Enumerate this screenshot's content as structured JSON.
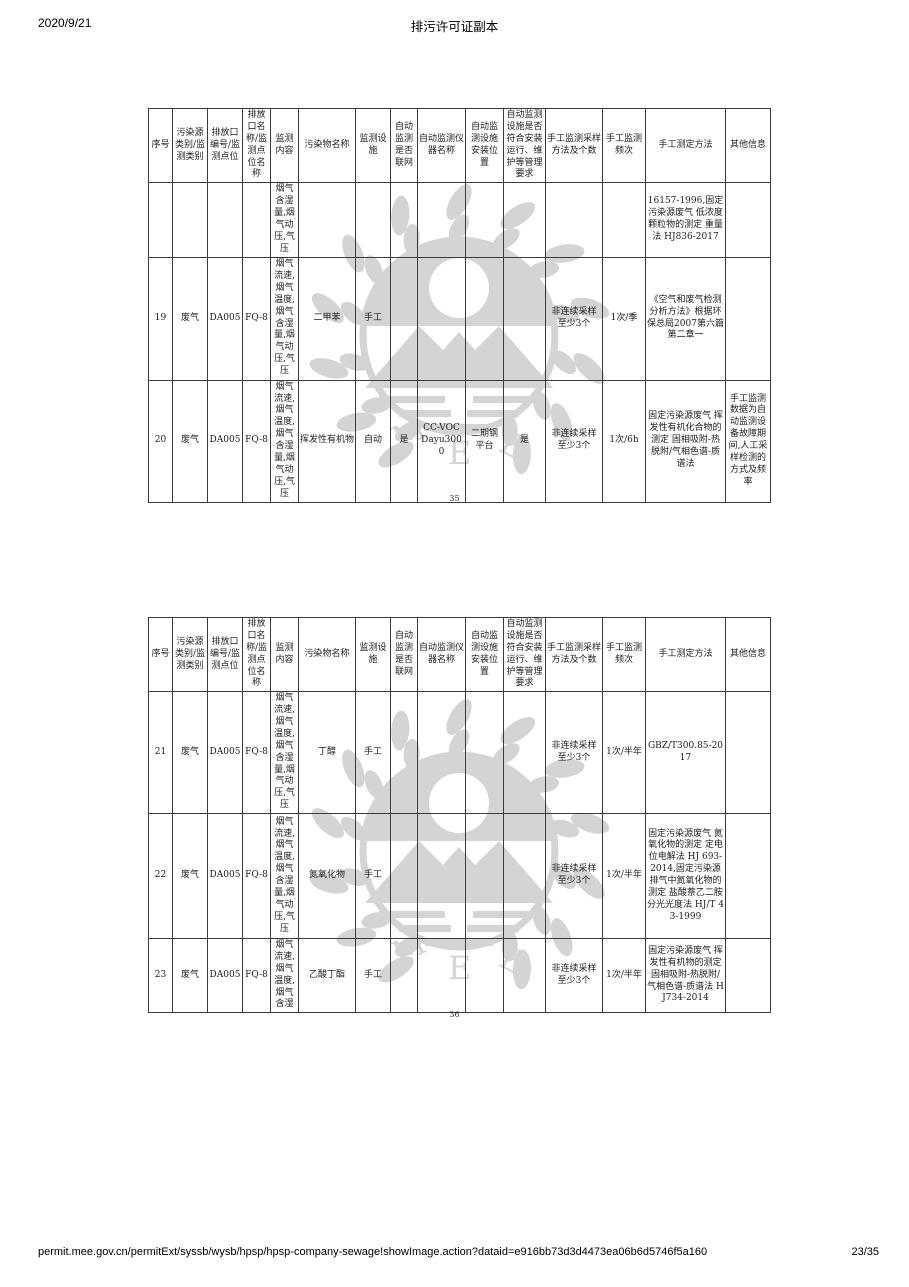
{
  "header": {
    "date": "2020/9/21",
    "title": "排污许可证副本"
  },
  "footer": {
    "url": "permit.mee.gov.cn/permitExt/syssb/wysb/hpsp/hpsp-company-sewage!showImage.action?dataid=e916bb73d3d4473ea06b6d5746f5a160",
    "page": "23/35"
  },
  "columns": [
    "序号",
    "污染源类别/监测类别",
    "排放口编号/监测点位",
    "排放口名称/监测点位名称",
    "监测内容",
    "污染物名称",
    "监测设施",
    "自动监测是否联网",
    "自动监测仪器名称",
    "自动监测设施安装位置",
    "自动监测设施是否符合安装运行、维护等管理要求",
    "手工监测采样方法及个数",
    "手工监测频次",
    "手工测定方法",
    "其他信息"
  ],
  "table1": {
    "page_label": "35",
    "rows": [
      {
        "seq": "",
        "category": "",
        "outlet_no": "",
        "outlet_name": "",
        "content": "烟气含湿量,烟气动压,气压",
        "pollutant": "",
        "facility": "",
        "networked": "",
        "instrument": "",
        "install_pos": "",
        "compliant": "",
        "sampling": "",
        "frequency": "",
        "method": "16157-1996,固定污染源废气 低浓度颗粒物的测定 重量法 HJ836-2017",
        "other": ""
      },
      {
        "seq": "19",
        "category": "废气",
        "outlet_no": "DA005",
        "outlet_name": "FQ-8",
        "content": "烟气流速,烟气温度,烟气含湿量,烟气动压,气压",
        "pollutant": "二甲苯",
        "facility": "手工",
        "networked": "",
        "instrument": "",
        "install_pos": "",
        "compliant": "",
        "sampling": "非连续采样 至少3个",
        "frequency": "1次/季",
        "method": "《空气和废气检测分析方法》根据环保总局2007第六篇第二章一",
        "other": ""
      },
      {
        "seq": "20",
        "category": "废气",
        "outlet_no": "DA005",
        "outlet_name": "FQ-8",
        "content": "烟气流速,烟气温度,烟气含湿量,烟气动压,气压",
        "pollutant": "挥发性有机物",
        "facility": "自动",
        "networked": "是",
        "instrument": "CC-VOC Dayu3000",
        "install_pos": "二期钢平台",
        "compliant": "是",
        "sampling": "非连续采样 至少3个",
        "frequency": "1次/6h",
        "method": "固定污染源废气 挥发性有机化合物的测定 固相吸附-热脱附/气相色谱-质谱法",
        "other": "手工监测数据为自动监测设备故障期间,人工采样检测的方式及频率"
      }
    ]
  },
  "table2": {
    "page_label": "36",
    "rows": [
      {
        "seq": "21",
        "category": "废气",
        "outlet_no": "DA005",
        "outlet_name": "FQ-8",
        "content": "烟气流速,烟气温度,烟气含湿量,烟气动压,气压",
        "pollutant": "丁醇",
        "facility": "手工",
        "networked": "",
        "instrument": "",
        "install_pos": "",
        "compliant": "",
        "sampling": "非连续采样 至少3个",
        "frequency": "1次/半年",
        "method": "GBZ/T300.85-2017",
        "other": ""
      },
      {
        "seq": "22",
        "category": "废气",
        "outlet_no": "DA005",
        "outlet_name": "FQ-8",
        "content": "烟气流速,烟气温度,烟气含湿量,烟气动压,气压",
        "pollutant": "氮氧化物",
        "facility": "手工",
        "networked": "",
        "instrument": "",
        "install_pos": "",
        "compliant": "",
        "sampling": "非连续采样 至少3个",
        "frequency": "1次/半年",
        "method": "固定污染源废气 氮氧化物的测定 定电位电解法 HJ 693-2014,固定污染源排气中氮氧化物的测定 盐酸萘乙二胺分光光度法 HJ/T 43-1999",
        "other": ""
      },
      {
        "seq": "23",
        "category": "废气",
        "outlet_no": "DA005",
        "outlet_name": "FQ-8",
        "content": "烟气流速,烟气温度,烟气含湿",
        "pollutant": "乙酸丁酯",
        "facility": "手工",
        "networked": "",
        "instrument": "",
        "install_pos": "",
        "compliant": "",
        "sampling": "非连续采样 至少3个",
        "frequency": "1次/半年",
        "method": "固定污染源废气 挥发性有机物的测定 固相吸附-热脱附/气相色谱-质谱法 HJ734-2014",
        "other": ""
      }
    ]
  },
  "watermark": {
    "color": "#d4d4d4",
    "m": "M",
    "e1": "E",
    "e2": "E"
  }
}
